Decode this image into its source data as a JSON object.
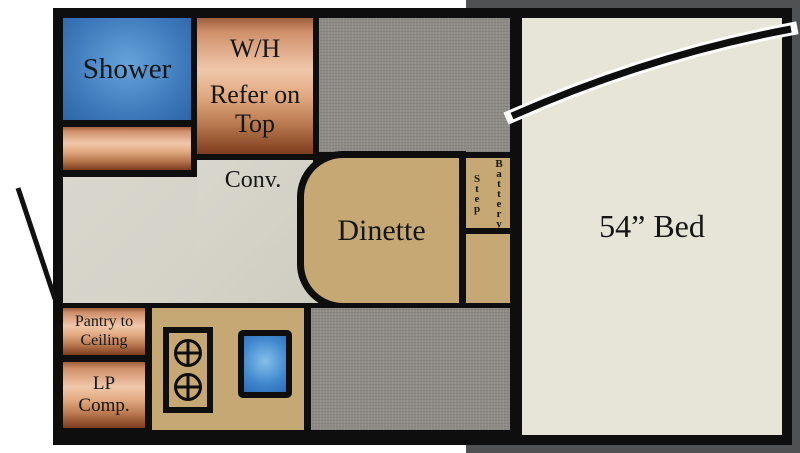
{
  "labels": {
    "shower": "Shower",
    "water_heater": "W/H",
    "refer": "Refer on\nTop",
    "convection": "Conv.",
    "dinette": "Dinette",
    "step": "Step",
    "battery": "Battery",
    "bed": "54” Bed",
    "pantry": "Pantry to\nCeiling",
    "lp_comp": "LP\nComp."
  },
  "colors": {
    "wall_black": "#0e0e0e",
    "copper_light": "#f1c7aa",
    "copper_dark": "#7e3c1e",
    "shower_blue": "#3a76b8",
    "sink_blue": "#4189cf",
    "counter_tan": "#c6a874",
    "storage_gray": "#8f8c88",
    "floor_gray": "#d4d2c8",
    "bed_cream": "#e6e5d8",
    "shadow_gray": "#505153",
    "background": "#ffffff"
  }
}
